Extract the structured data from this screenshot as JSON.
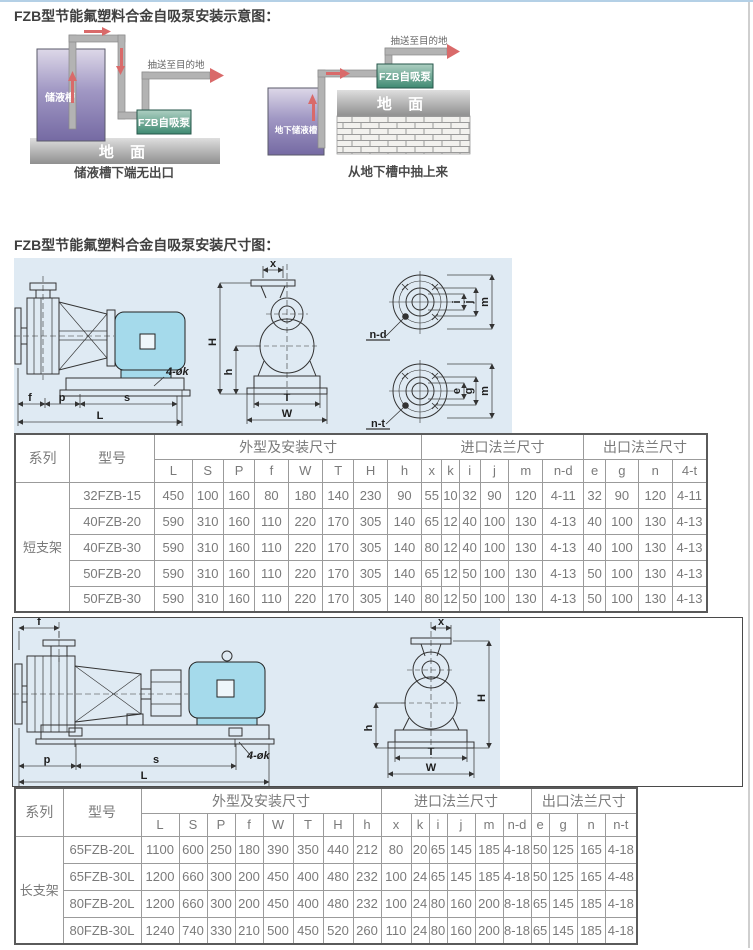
{
  "page": {
    "title_schematic": "FZB型节能氟塑料合金自吸泵安装示意图：",
    "title_dimensions": "FZB型节能氟塑料合金自吸泵安装尺寸图："
  },
  "colors": {
    "top_border": "#b4d0e6",
    "drawing_background": "#dfeaf3",
    "motor_fill": "#a5daeb",
    "tank_gradient_top": "#ddd8e8",
    "tank_gradient_bottom": "#756aa3",
    "pump_box_teal": "#3f8a72",
    "ground_gray": "#8f8f8f",
    "red_arrow": "#d96a6a"
  },
  "schematic": {
    "left": {
      "tank": "储液槽",
      "pump": "FZB自吸泵",
      "ground": "地 面",
      "destination": "抽送至目的地",
      "caption": "储液槽下端无出口"
    },
    "right": {
      "tank": "地下储液槽",
      "pump": "FZB自吸泵",
      "ground": "地 面",
      "destination": "抽送至目的地",
      "caption": "从地下槽中抽上来"
    }
  },
  "drawing_short": {
    "dims": {
      "f": "f",
      "p": "p",
      "s": "s",
      "L": "L",
      "bolt": "4-øk",
      "x": "x",
      "H": "H",
      "h": "h",
      "T": "T",
      "W": "W",
      "i": "i",
      "j": "j",
      "m": "m",
      "e": "e",
      "g": "g",
      "nd": "n-d",
      "nt": "n-t"
    }
  },
  "drawing_long": {
    "dims": {
      "f": "f",
      "p": "p",
      "s": "s",
      "L": "L",
      "bolt": "4-øk",
      "x": "x",
      "H": "H",
      "h": "h",
      "T": "T",
      "W": "W"
    }
  },
  "table_short": {
    "group_headers": {
      "series": "系列",
      "model": "型号",
      "outline": "外型及安装尺寸",
      "inlet": "进口法兰尺寸",
      "outlet": "出口法兰尺寸"
    },
    "columns": [
      "L",
      "S",
      "P",
      "f",
      "W",
      "T",
      "H",
      "h",
      "x",
      "k",
      "i",
      "j",
      "m",
      "n-d",
      "e",
      "g",
      "n",
      "4-t"
    ],
    "series": "短支架",
    "rows": [
      {
        "model": "32FZB-15",
        "values": [
          "450",
          "100",
          "160",
          "80",
          "180",
          "140",
          "230",
          "90",
          "55",
          "10",
          "32",
          "90",
          "120",
          "4-11",
          "32",
          "90",
          "120",
          "4-11"
        ]
      },
      {
        "model": "40FZB-20",
        "values": [
          "590",
          "310",
          "160",
          "110",
          "220",
          "170",
          "305",
          "140",
          "65",
          "12",
          "40",
          "100",
          "130",
          "4-13",
          "40",
          "100",
          "130",
          "4-13"
        ]
      },
      {
        "model": "40FZB-30",
        "values": [
          "590",
          "310",
          "160",
          "110",
          "220",
          "170",
          "305",
          "140",
          "80",
          "12",
          "40",
          "100",
          "130",
          "4-13",
          "40",
          "100",
          "130",
          "4-13"
        ]
      },
      {
        "model": "50FZB-20",
        "values": [
          "590",
          "310",
          "160",
          "110",
          "220",
          "170",
          "305",
          "140",
          "65",
          "12",
          "50",
          "100",
          "130",
          "4-13",
          "50",
          "100",
          "130",
          "4-13"
        ]
      },
      {
        "model": "50FZB-30",
        "values": [
          "590",
          "310",
          "160",
          "110",
          "220",
          "170",
          "305",
          "140",
          "80",
          "12",
          "50",
          "100",
          "130",
          "4-13",
          "50",
          "100",
          "130",
          "4-13"
        ]
      }
    ]
  },
  "table_long": {
    "group_headers": {
      "series": "系列",
      "model": "型号",
      "outline": "外型及安装尺寸",
      "inlet": "进口法兰尺寸",
      "outlet": "出口法兰尺寸"
    },
    "columns": [
      "L",
      "S",
      "P",
      "f",
      "W",
      "T",
      "H",
      "h",
      "x",
      "k",
      "i",
      "j",
      "m",
      "n-d",
      "e",
      "g",
      "n",
      "n-t"
    ],
    "series": "长支架",
    "rows": [
      {
        "model": "65FZB-20L",
        "values": [
          "1100",
          "600",
          "250",
          "180",
          "390",
          "350",
          "440",
          "212",
          "80",
          "20",
          "65",
          "145",
          "185",
          "4-18",
          "50",
          "125",
          "165",
          "4-18"
        ]
      },
      {
        "model": "65FZB-30L",
        "values": [
          "1200",
          "660",
          "300",
          "200",
          "450",
          "400",
          "480",
          "232",
          "100",
          "24",
          "65",
          "145",
          "185",
          "4-18",
          "50",
          "125",
          "165",
          "4-48"
        ]
      },
      {
        "model": "80FZB-20L",
        "values": [
          "1200",
          "660",
          "300",
          "200",
          "450",
          "400",
          "480",
          "232",
          "100",
          "24",
          "80",
          "160",
          "200",
          "8-18",
          "65",
          "145",
          "185",
          "4-18"
        ]
      },
      {
        "model": "80FZB-30L",
        "values": [
          "1240",
          "740",
          "330",
          "210",
          "500",
          "450",
          "520",
          "260",
          "110",
          "24",
          "80",
          "160",
          "200",
          "8-18",
          "65",
          "145",
          "185",
          "4-18"
        ]
      }
    ]
  }
}
